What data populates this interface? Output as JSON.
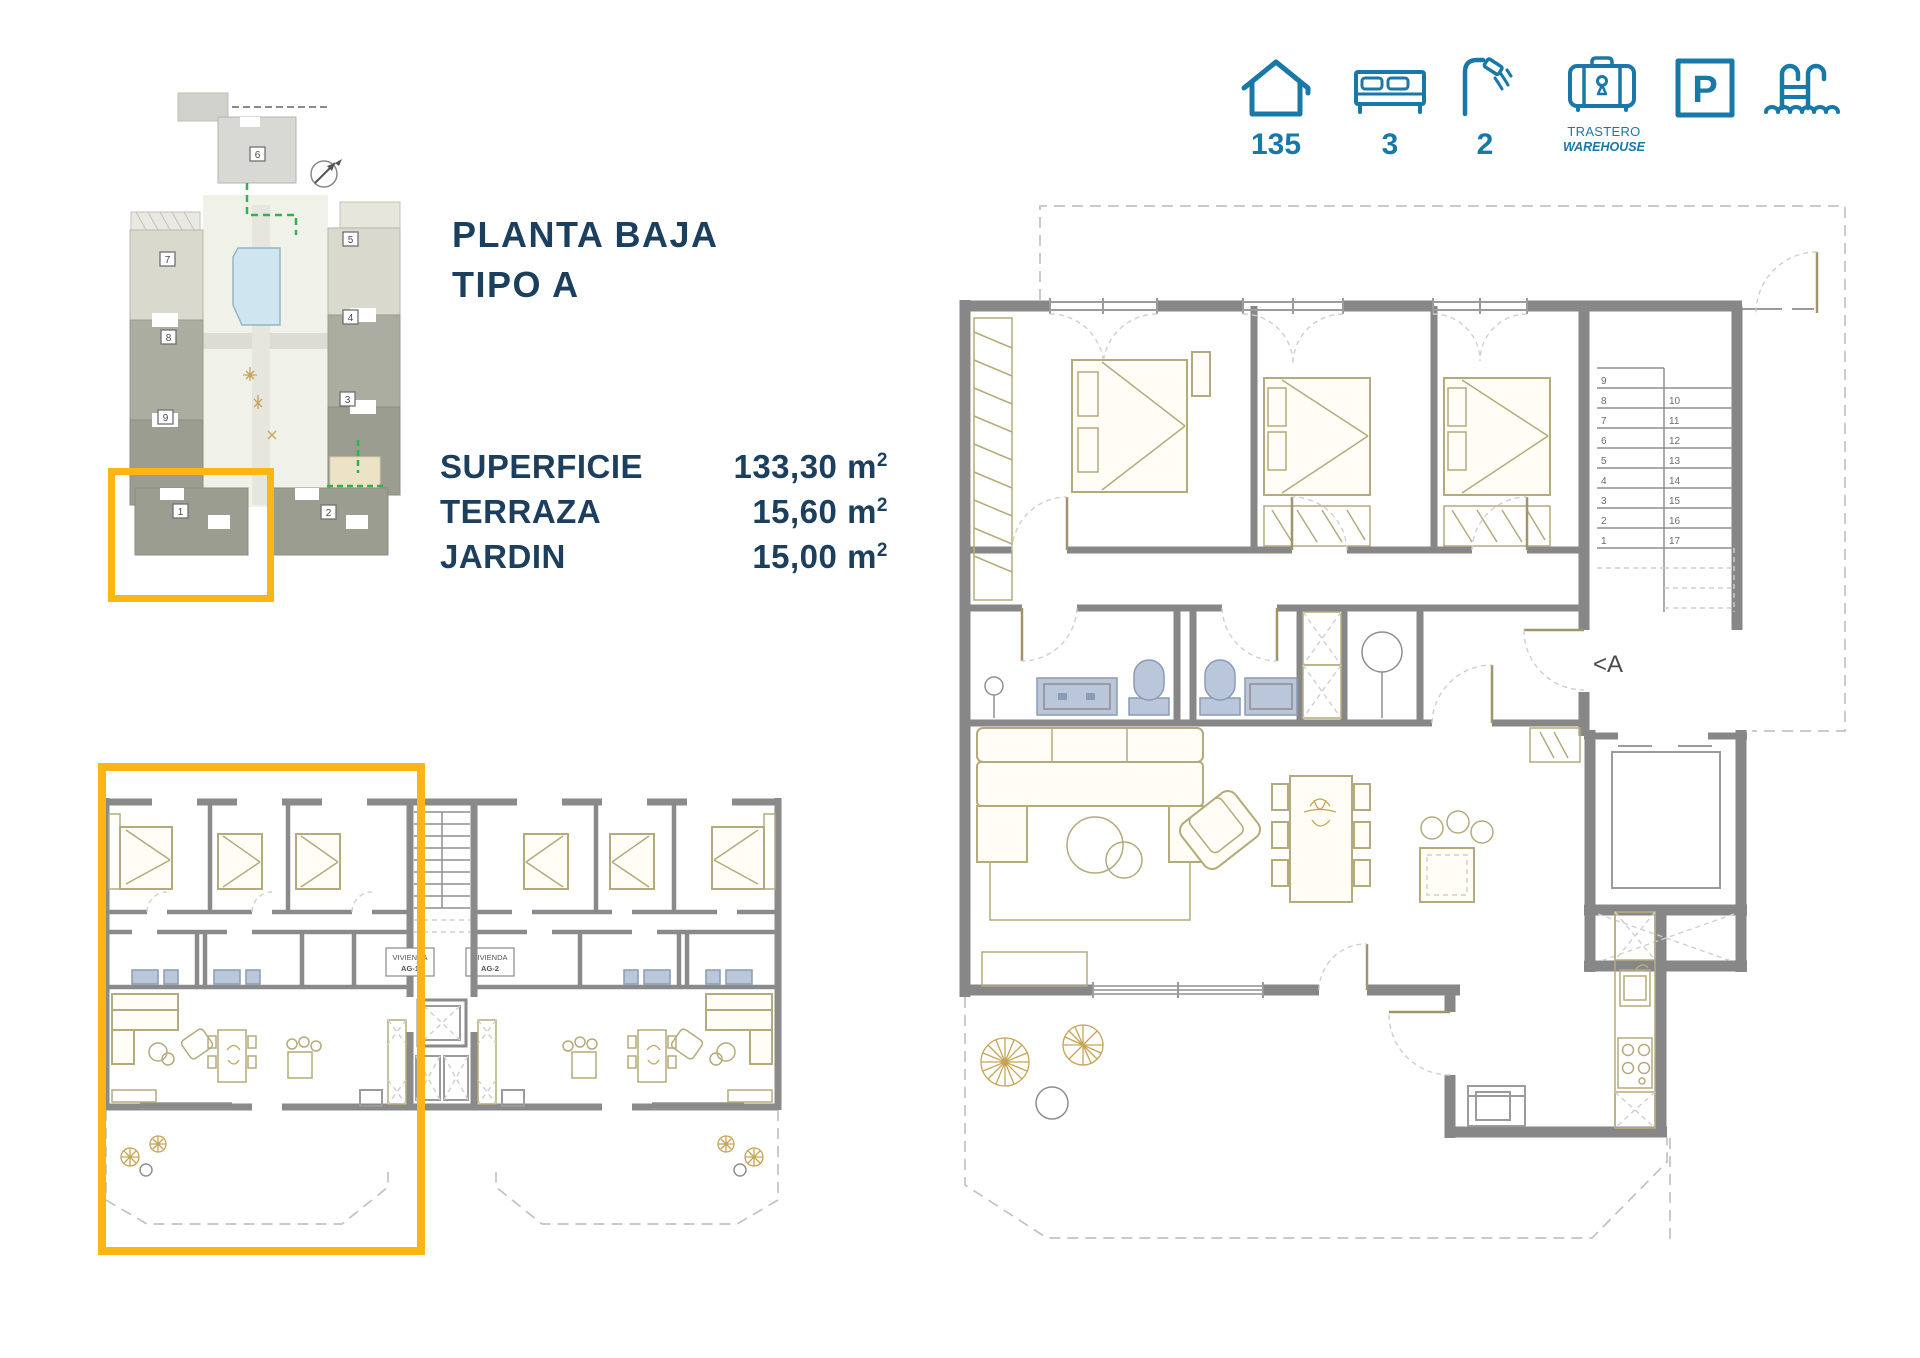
{
  "title": {
    "line1": "PLANTA BAJA",
    "line2": "TIPO A"
  },
  "specs": {
    "rows": [
      {
        "label": "SUPERFICIE",
        "value": "133,30",
        "unit": "m",
        "sup": "2"
      },
      {
        "label": "TERRAZA",
        "value": "15,60",
        "unit": "m",
        "sup": "2"
      },
      {
        "label": "JARDIN",
        "value": "15,00",
        "unit": "m",
        "sup": "2"
      }
    ]
  },
  "amenities": [
    {
      "name": "house",
      "value": "135"
    },
    {
      "name": "bed",
      "value": "3"
    },
    {
      "name": "shower",
      "value": "2"
    },
    {
      "name": "storage",
      "label_top": "TRASTERO",
      "label_bottom": "WAREHOUSE"
    },
    {
      "name": "parking",
      "letter": "P"
    },
    {
      "name": "pool"
    }
  ],
  "site_plan": {
    "building_labels": [
      "1",
      "2",
      "3",
      "4",
      "5",
      "6",
      "7",
      "8",
      "9"
    ]
  },
  "large_plan": {
    "section_label": "<A",
    "stair_numbers_left": [
      "9",
      "8",
      "7",
      "6",
      "5",
      "4",
      "3",
      "2",
      "1"
    ],
    "stair_numbers_right": [
      "10",
      "11",
      "12",
      "13",
      "14",
      "15",
      "16",
      "17"
    ]
  },
  "small_plan": {
    "units": [
      {
        "line1": "VIVIENDA",
        "line2": "AG-1"
      },
      {
        "line1": "VIVIENDA",
        "line2": "AG-2"
      }
    ]
  },
  "colors": {
    "accent_yellow": "#fbb616",
    "brand_blue": "#1878a8",
    "navy_text": "#1c3f5e",
    "wall_gray": "#878787",
    "furniture_khaki": "#b5aa7a",
    "fixture_blue": "#bac6da",
    "pool_blue": "#cfe5ef"
  }
}
